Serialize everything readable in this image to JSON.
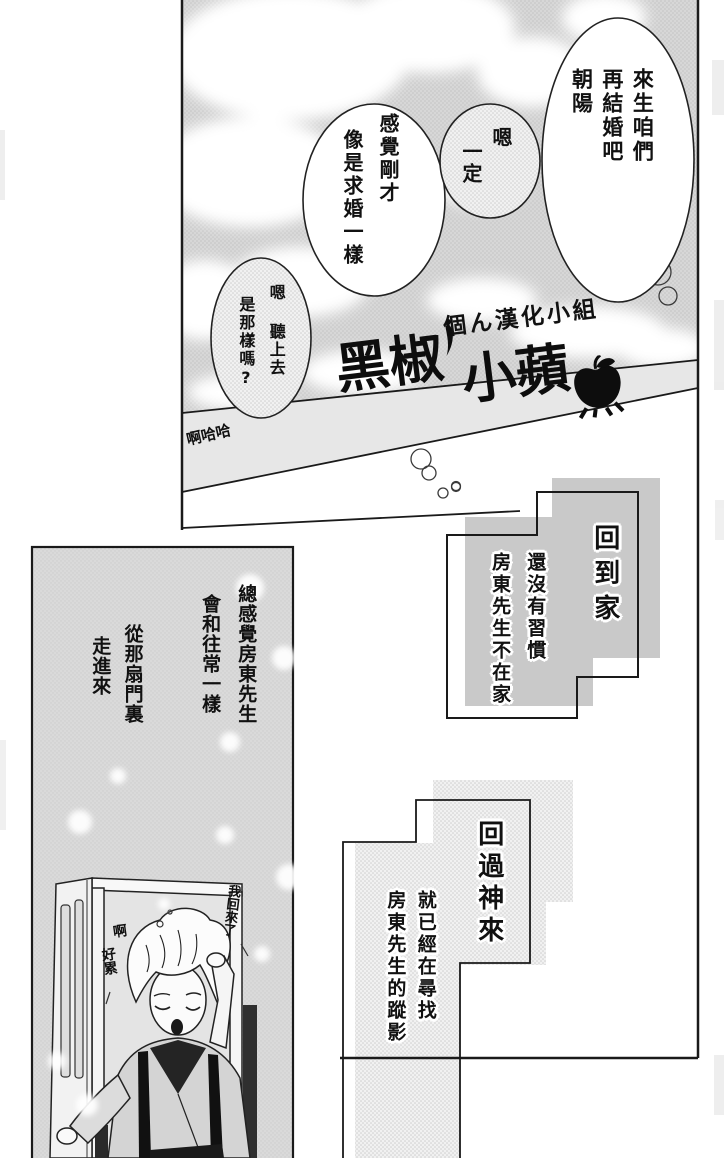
{
  "colors": {
    "ink": "#1a1a1a",
    "sky_gray": "#d6d6d6",
    "wall_band": "#e7e7e7",
    "panel_gray": "#d8d8d8",
    "box_gray": "#c9c9c9"
  },
  "watermark": {
    "group_name": "個ん漢化小組",
    "logo_part1": "黑椒",
    "logo_part2": "小蘋",
    "icons": [
      "chili-icon",
      "apple-icon"
    ]
  },
  "panel1": {
    "bubbles": [
      {
        "lines": [
          "來生咱們",
          "再結婚吧",
          "朝陽"
        ]
      },
      {
        "lines": [
          "嗯",
          "一定"
        ]
      },
      {
        "lines": [
          "感覺剛才",
          "像是求婚一樣"
        ]
      },
      {
        "lines": [
          "嗯 聽上去",
          "是那樣嗎?"
        ]
      }
    ],
    "laugh": "啊哈哈"
  },
  "panel2": {
    "narration1": [
      "總感覺房東先生",
      "會和往常一樣"
    ],
    "narration2": [
      "從那扇門裏",
      "走進來"
    ],
    "speech": [
      "我回來了",
      "啊",
      "好累"
    ]
  },
  "panel3": {
    "caption": "回到家",
    "narration": [
      "還沒有習慣",
      "房東先生不在家"
    ]
  },
  "panel4": {
    "caption": "回過神來",
    "narration": [
      "就已經在尋找",
      "房東先生的蹤影"
    ]
  }
}
